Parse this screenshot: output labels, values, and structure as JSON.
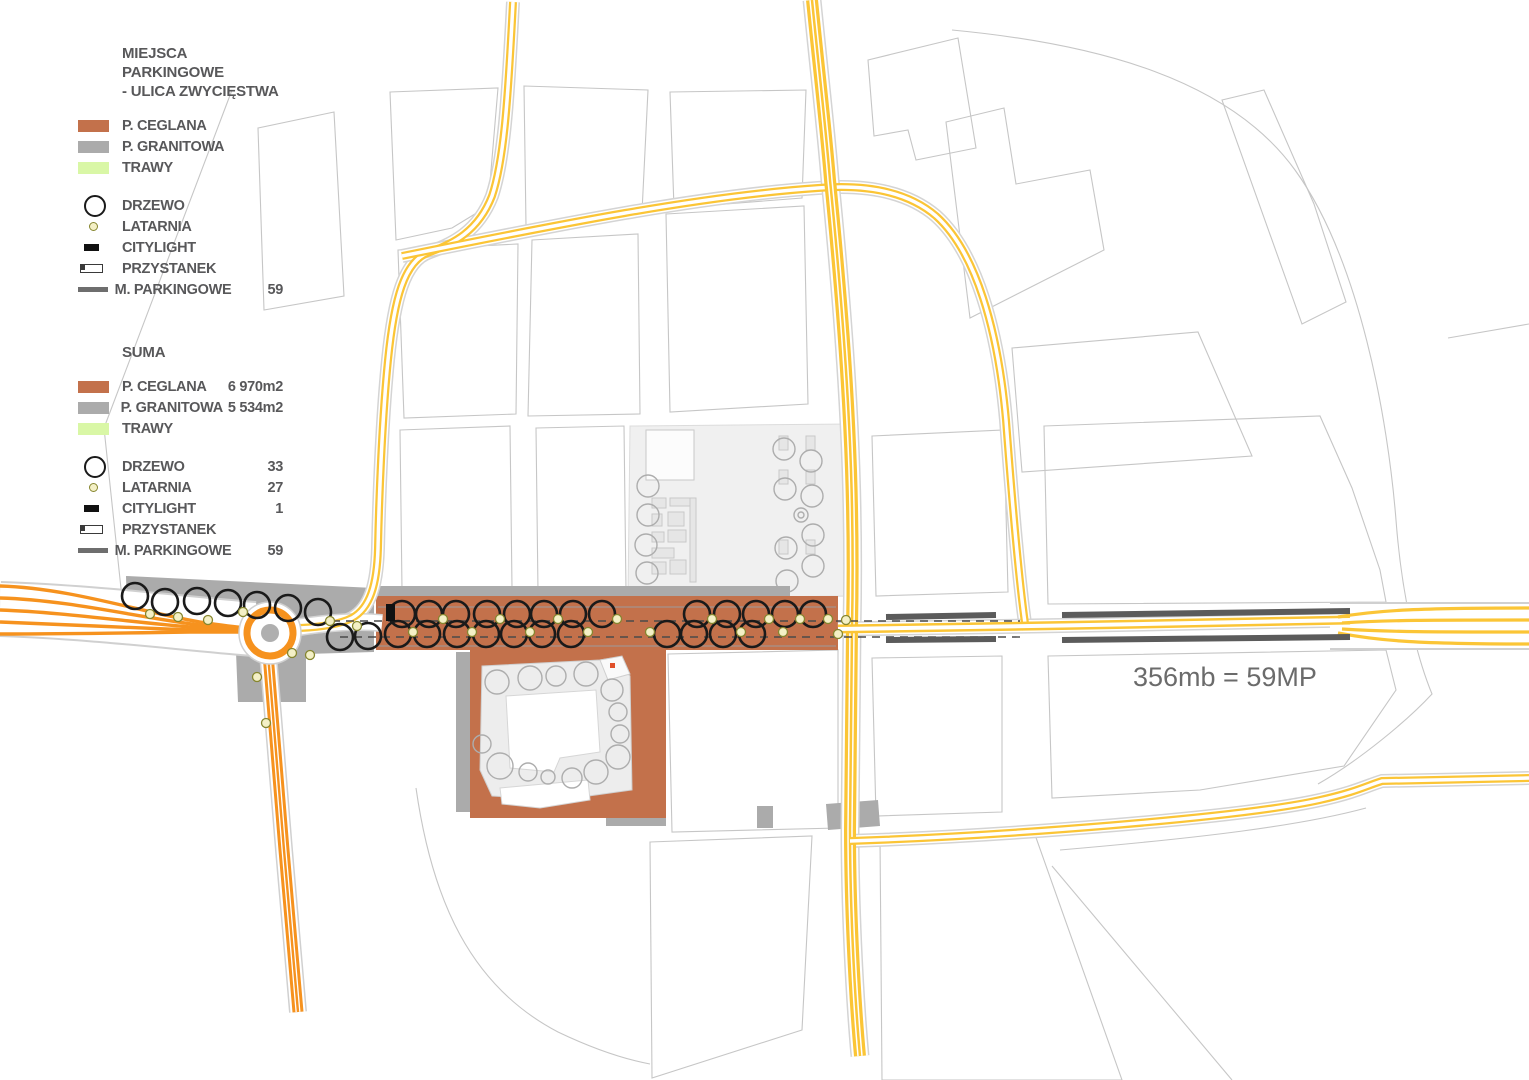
{
  "legend": {
    "section_parking": {
      "title_line1": "MIEJSCA PARKINGOWE",
      "title_line2": "- ULICA ZWYCIĘSTWA",
      "rows_surface": [
        {
          "label": "P. CEGLANA",
          "color": "#C3714B"
        },
        {
          "label": "P.  GRANITOWA",
          "color": "#ABABAB"
        },
        {
          "label": "TRAWY",
          "color": "#D9F7A6"
        }
      ],
      "rows_symbol": [
        {
          "icon": "tree-icon",
          "label": "DRZEWO",
          "value": ""
        },
        {
          "icon": "lantern-icon",
          "label": "LATARNIA",
          "value": ""
        },
        {
          "icon": "citylight-icon",
          "label": "CITYLIGHT",
          "value": ""
        },
        {
          "icon": "bus-stop-icon",
          "label": "PRZYSTANEK",
          "value": ""
        },
        {
          "icon": "parking-line-icon",
          "label": "M. PARKINGOWE",
          "value": "59"
        }
      ]
    },
    "section_suma": {
      "title": "SUMA",
      "rows_surface": [
        {
          "label": "P. CEGLANA",
          "color": "#C3714B",
          "value": "6 970m2"
        },
        {
          "label": "P.  GRANITOWA",
          "color": "#ABABAB",
          "value": "5 534m2"
        },
        {
          "label": "TRAWY",
          "color": "#D9F7A6",
          "value": ""
        }
      ],
      "rows_symbol": [
        {
          "icon": "tree-icon",
          "label": "DRZEWO",
          "value": "33"
        },
        {
          "icon": "lantern-icon",
          "label": "LATARNIA",
          "value": "27"
        },
        {
          "icon": "citylight-icon",
          "label": "CITYLIGHT",
          "value": "1"
        },
        {
          "icon": "bus-stop-icon",
          "label": "PRZYSTANEK",
          "value": ""
        },
        {
          "icon": "parking-line-icon",
          "label": "M. PARKINGOWE",
          "value": "59"
        }
      ]
    }
  },
  "map": {
    "annotation": "356mb = 59MP",
    "colors": {
      "ceglana": "#C3714B",
      "granitowa": "#ABABAB",
      "trawy": "#D9F7A6",
      "road_primary_orange": "#F6921E",
      "road_secondary_yellow": "#FBC536",
      "parking_line": "#5B5B5B",
      "plaza_fill": "#F0F0F0",
      "block_outline": "#C6C6C6",
      "lantern_fill": "#F4F0C6",
      "tree_outline": "#1A1A1A",
      "text": "#6B6B6B"
    }
  }
}
